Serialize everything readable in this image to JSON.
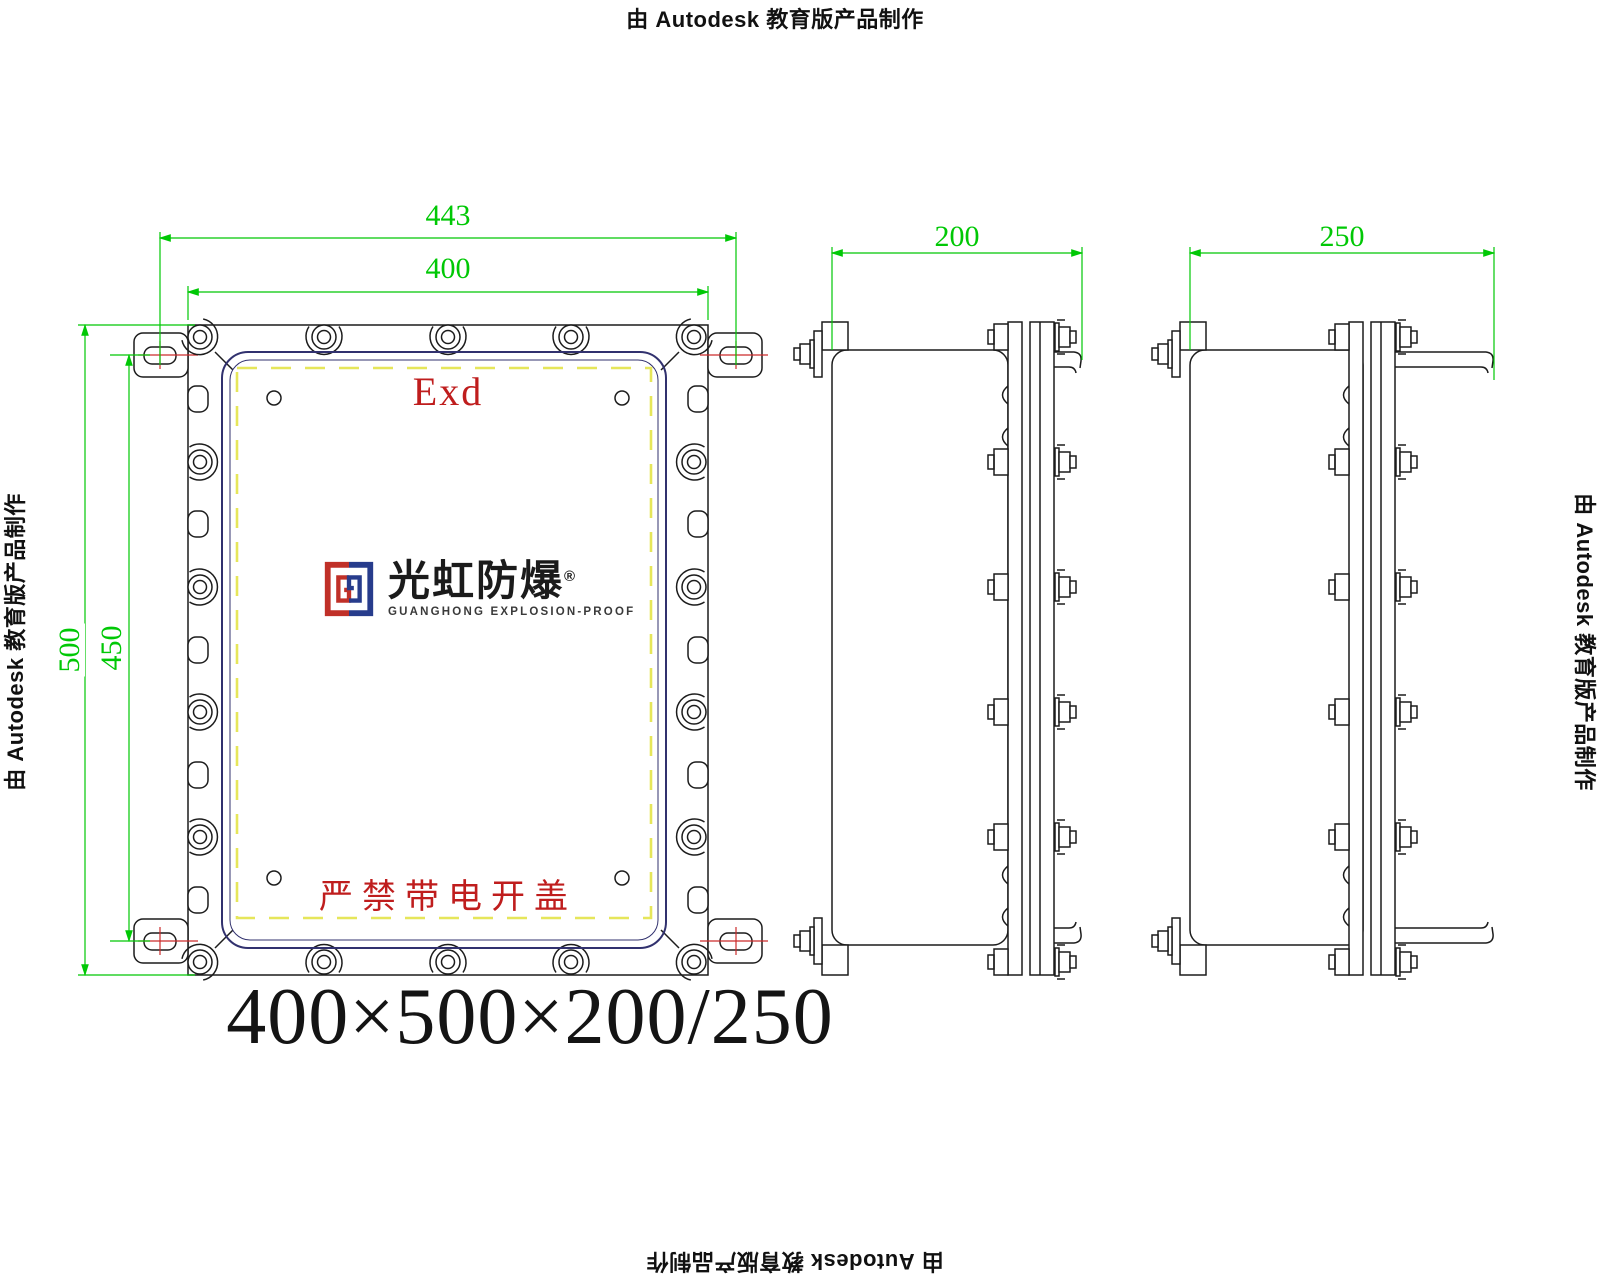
{
  "watermark": {
    "text": "由 Autodesk 教育版产品制作"
  },
  "front_view": {
    "marking": "Exd",
    "warning": "严禁带电开盖",
    "logo": {
      "name": "光虹防爆",
      "registered": "®",
      "tagline": "GUANGHONG EXPLOSION-PROOF"
    }
  },
  "dimensions": {
    "flange_width": "443",
    "body_width": "400",
    "body_height": "500",
    "mount_spacing": "450",
    "depth_standard": "200",
    "depth_deep": "250"
  },
  "size_label": "400×500×200/250",
  "colors": {
    "dimension_green": "#00c805",
    "centerline_red": "#cc2a2a",
    "marking_red": "#bf1d1d",
    "cover_outline_navy": "#31316e",
    "gasket_dashed_yellow": "#e6e65a",
    "logo_red": "#c03028",
    "logo_blue": "#273c8c"
  }
}
